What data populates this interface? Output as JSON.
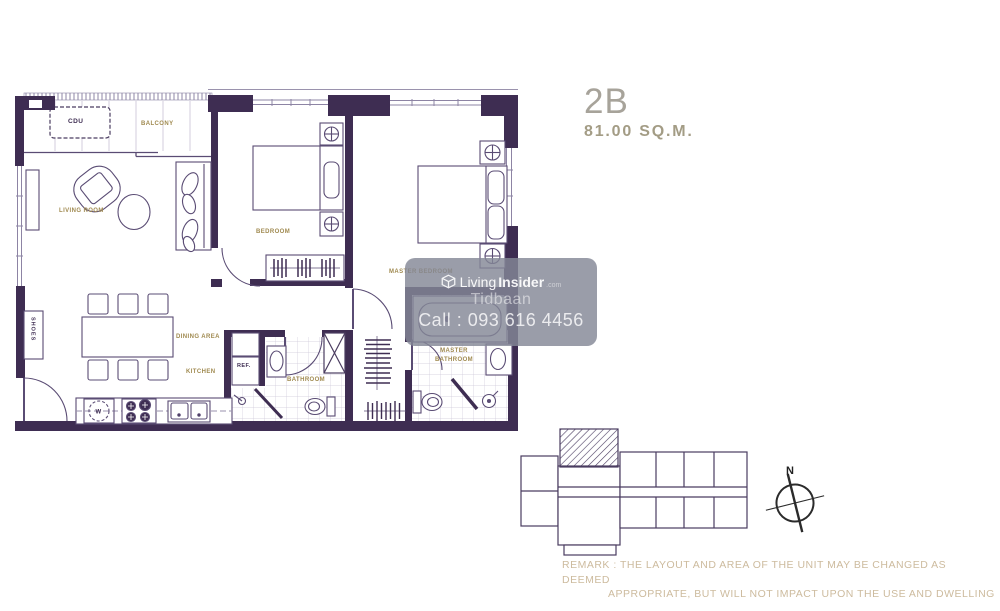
{
  "title": {
    "unit_code": "2B",
    "unit_area": "81.00 SQ.M."
  },
  "floorplan": {
    "labels": {
      "cdu": "CDU",
      "balcony": "BALCONY",
      "living_room": "LIVING ROOM",
      "bedroom": "BEDROOM",
      "master_bedroom": "MASTER BEDROOM",
      "dining_area": "DINING AREA",
      "kitchen": "KITCHEN",
      "bathroom": "BATHROOM",
      "master_bathroom_line1": "MASTER",
      "master_bathroom_line2": "BATHROOM",
      "refrigerator": "REF.",
      "shoes": "SHOES",
      "washer": "W"
    }
  },
  "watermark": {
    "brand_prefix": "Living",
    "brand_suffix": "Insider",
    "brand_domain": ".com",
    "agent_name": "Tidbaan",
    "phone": "Call : 093 616 4456"
  },
  "keyplan": {
    "north": "N"
  },
  "remark": {
    "line1": "REMARK : THE LAYOUT AND AREA OF THE UNIT MAY BE CHANGED AS DEEMED",
    "line2": "APPROPRIATE, BUT WILL NOT IMPACT UPON THE USE AND DWELLING"
  },
  "colors": {
    "wall": "#3e2d52",
    "furniture_line": "#5a4c74",
    "light_line": "#9a92ad",
    "gold_label": "#a08a50",
    "title_text": "#a7a39a",
    "area_text": "#a39c85",
    "remark_text": "#cdbb9e",
    "watermark_bg": "rgba(132,136,150,0.82)"
  }
}
